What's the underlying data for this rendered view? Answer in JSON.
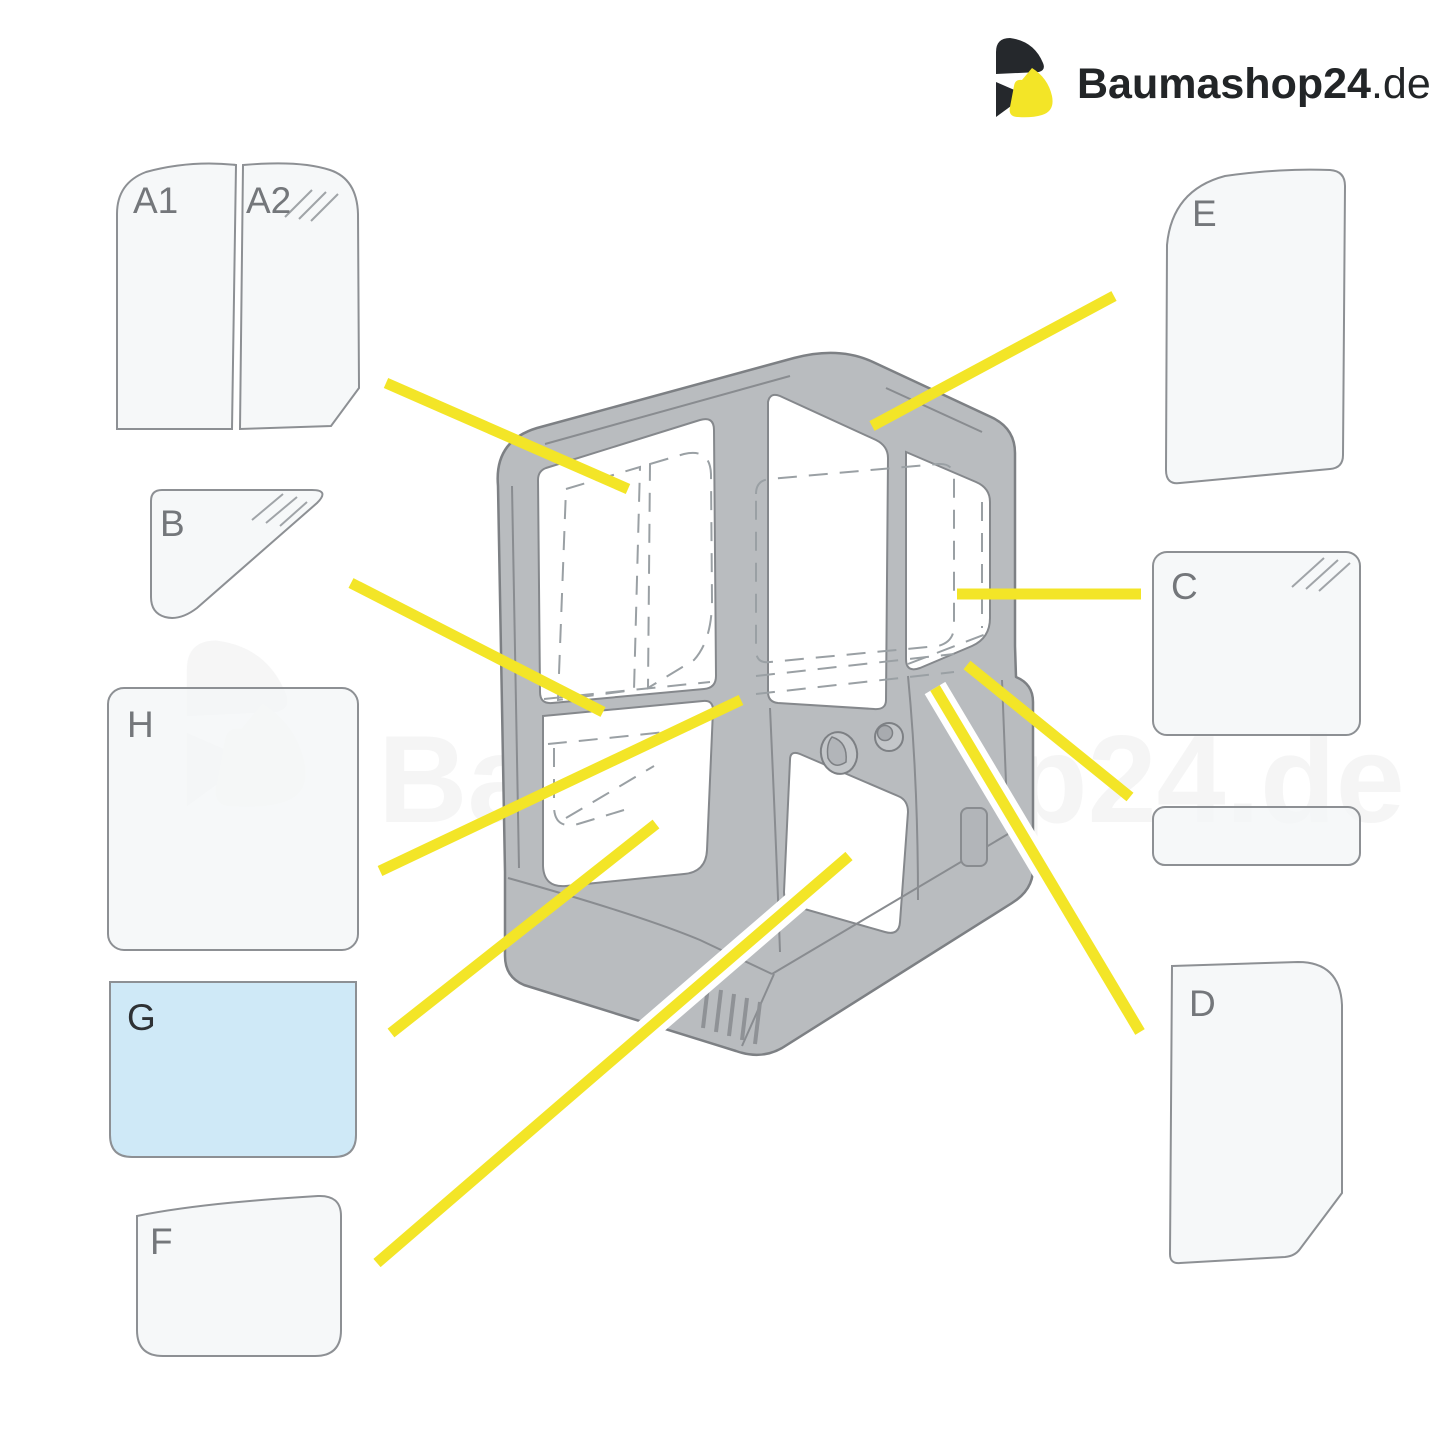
{
  "logo": {
    "main": "Baumashop",
    "number": "24",
    "tld": ".de"
  },
  "watermark": {
    "text": "Baumashop24.de"
  },
  "panels": {
    "a1": {
      "label": "A1"
    },
    "a2": {
      "label": "A2"
    },
    "b": {
      "label": "B"
    },
    "h": {
      "label": "H"
    },
    "g": {
      "label": "G"
    },
    "f": {
      "label": "F"
    },
    "e": {
      "label": "E"
    },
    "c": {
      "label": "C"
    },
    "spare": {
      "label": ""
    },
    "d": {
      "label": "D"
    }
  },
  "colors": {
    "accent_yellow": "#f3e527",
    "cab_gray": "#b9bcbf",
    "cab_outline": "#7d8084",
    "panel_fill": "#f3f5f7",
    "panel_stroke": "#8d9094",
    "highlight_blue": "#cfe9f7",
    "label_gray": "#74777b",
    "logo_dark": "#222527"
  }
}
